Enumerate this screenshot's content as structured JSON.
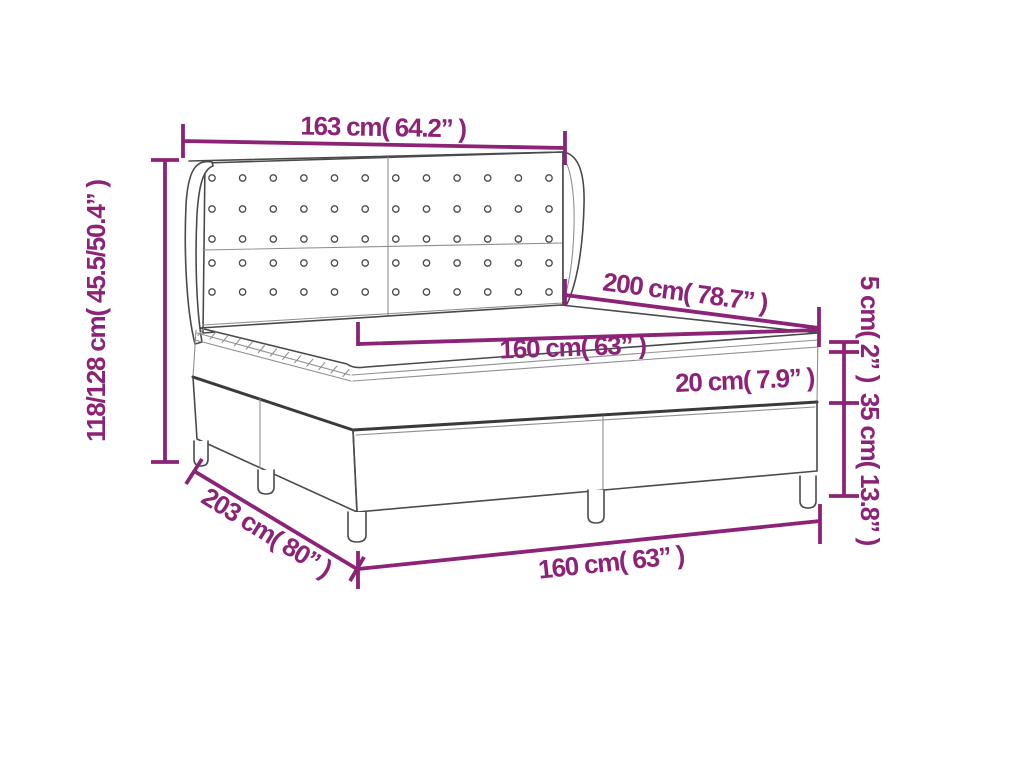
{
  "diagram": {
    "type": "product-dimension-diagram",
    "product": "box-spring-bed-with-winged-tufted-headboard",
    "colors": {
      "accent": "#8C2377",
      "line": "#4A4A4A",
      "line_thick": "#3A3A3A",
      "line_thin": "#8F8F8F",
      "background": "#FFFFFF"
    },
    "headboard": {
      "button_rows": 5,
      "button_columns": 12
    },
    "measurements": {
      "headboard_width": "163 cm( 64.2” )",
      "total_height": "118/128 cm( 45.5/50.4” )",
      "bed_length": "200 cm( 78.7” )",
      "mattress_width_top": "160 cm( 63” )",
      "mattress_height": "20 cm( 7.9” )",
      "topper_height": "5 cm( 2” )",
      "base_height": "35 cm( 13.8” )",
      "total_depth": "203 cm( 80” )",
      "bed_width_bottom": "160 cm( 63” )"
    }
  }
}
